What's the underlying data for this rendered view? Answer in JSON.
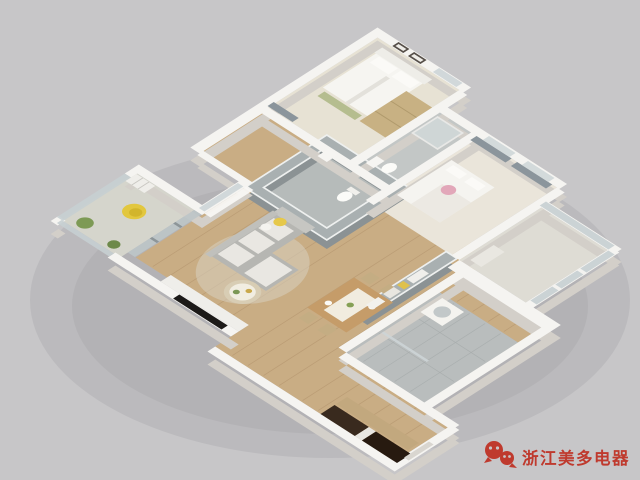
{
  "meta": {
    "title": "3D apartment floor plan render",
    "type": "isometric-cutaway-3d-floor-plan"
  },
  "canvas": {
    "width": 640,
    "height": 480,
    "background": "#c7c6c8"
  },
  "watermark": {
    "icon": "wechat-icon",
    "text": "浙江美多电器",
    "color": "#bf3a2e"
  },
  "palette": {
    "background": "#c7c6c8",
    "wall_top": "#f5f4f1",
    "wall_side": "#d3cfc9",
    "interior_wall_top": "#a9b0b1",
    "interior_wall_side": "#8b9294",
    "wood_floor": "#c9ad84",
    "tile_floor": "#b9bdbd",
    "bedroom_floor": "#e7e2d4",
    "balcony_floor": "#d5d5cc",
    "glass": "#c6cfd2",
    "curtain": "#8b959c",
    "sofa": "#b6b6b2",
    "bed_white": "#f6f5f1",
    "wood_furniture": "#c59c69",
    "wardrobe_tan": "#c8b183",
    "accent_yellow": "#e2c73e",
    "accent_pink": "#e2a7b9",
    "plant_green": "#7d9a55",
    "dark_cabinet": "#392a1e",
    "tv_black": "#1c1a18"
  },
  "scene": {
    "description": "Isometric 3D cutaway render of a three-bedroom apartment viewed from above, white walls, wood floors, gray bathroom core, on plain gray background",
    "rooms": [
      {
        "name": "west-balcony",
        "furniture": [
          "hanging-egg-chair",
          "plants",
          "shelf-unit"
        ]
      },
      {
        "name": "living-room",
        "furniture": [
          "l-shaped-sofa",
          "round-coffee-table",
          "wall-tv",
          "tv-cabinet",
          "rug",
          "sheer-curtains"
        ]
      },
      {
        "name": "master-bedroom",
        "furniture": [
          "double-bed",
          "wardrobe",
          "bench",
          "picture-frames",
          "curtain"
        ]
      },
      {
        "name": "center-bathroom",
        "furniture": [
          "toilet",
          "sink"
        ]
      },
      {
        "name": "hall-bathroom",
        "furniture": [
          "shower-enclosure",
          "toilet",
          "sink"
        ]
      },
      {
        "name": "kids-bedroom",
        "furniture": [
          "single-bed",
          "window-curtains"
        ]
      },
      {
        "name": "study-balcony",
        "furniture": [
          "desk",
          "picture-window"
        ]
      },
      {
        "name": "dining-room",
        "furniture": [
          "wood-dining-table",
          "chairs",
          "gray-feature-wall-with-shelf"
        ]
      },
      {
        "name": "laundry-bathroom",
        "furniture": [
          "washing-machine",
          "shower-screen"
        ]
      },
      {
        "name": "kitchen-entry",
        "furniture": [
          "dark-cabinets",
          "wood-counter",
          "entry-door"
        ]
      }
    ]
  }
}
